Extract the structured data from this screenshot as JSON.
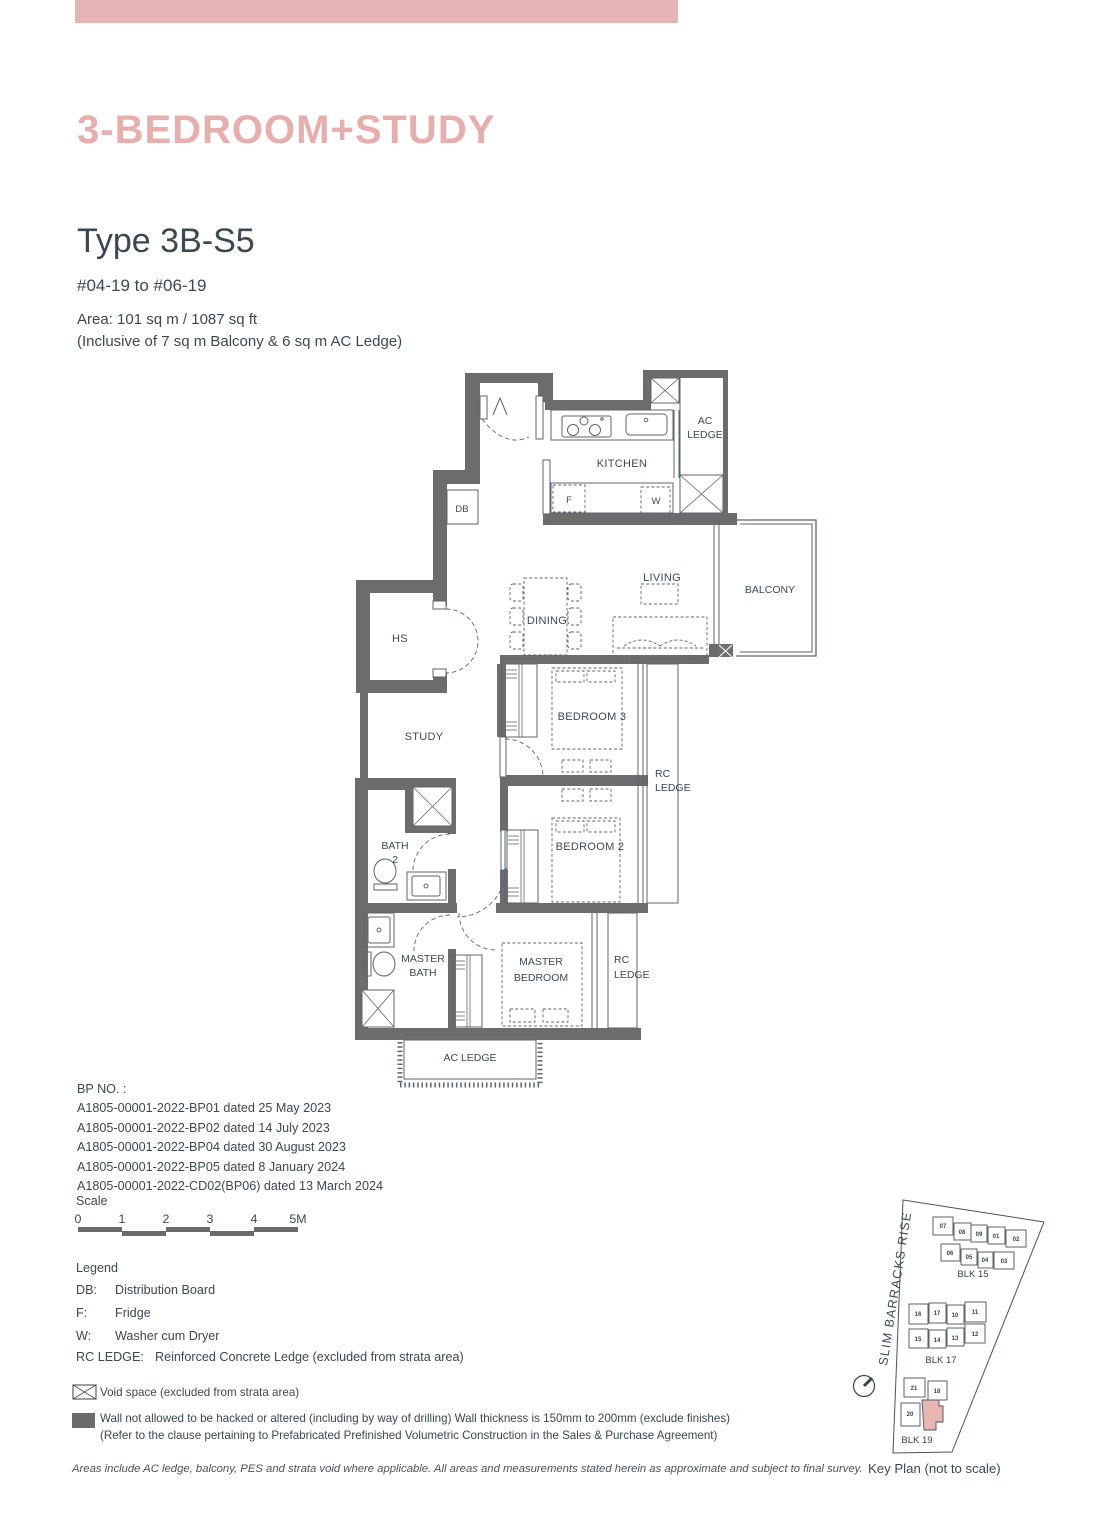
{
  "header": {
    "title": "3-BEDROOM+STUDY"
  },
  "unit": {
    "type": "Type 3B-S5",
    "range": "#04-19 to #06-19",
    "area": "Area: 101 sq m / 1087 sq ft",
    "area_note": "(Inclusive of 7 sq m Balcony & 6 sq m AC Ledge)"
  },
  "plan": {
    "kitchen": "KITCHEN",
    "ac": "AC",
    "ledge": "LEDGE",
    "ac_ledge": "AC LEDGE",
    "living": "LIVING",
    "balcony": "BALCONY",
    "dining": "DINING",
    "hs": "HS",
    "db": "DB",
    "fridge": "F",
    "washer": "W",
    "study": "STUDY",
    "bedroom3": "BEDROOM 3",
    "bedroom2": "BEDROOM 2",
    "rc": "RC",
    "bath": "BATH",
    "bath_no": "2",
    "master": "MASTER",
    "bedroom": "BEDROOM"
  },
  "bp": {
    "heading": "BP NO. :",
    "lines": [
      "A1805-00001-2022-BP01 dated 25 May 2023",
      "A1805-00001-2022-BP02 dated 14 July 2023",
      "A1805-00001-2022-BP04 dated 30 August 2023",
      "A1805-00001-2022-BP05 dated 8 January 2024",
      "A1805-00001-2022-CD02(BP06) dated 13 March 2024"
    ]
  },
  "scale": {
    "heading": "Scale",
    "ticks": [
      "0",
      "1",
      "2",
      "3",
      "4",
      "5M"
    ]
  },
  "legend": {
    "heading": "Legend",
    "items": [
      {
        "key": "DB:",
        "value": "Distribution Board"
      },
      {
        "key": "F:",
        "value": "Fridge"
      },
      {
        "key": "W:",
        "value": "Washer cum Dryer"
      },
      {
        "key": "RC LEDGE:",
        "value": "Reinforced Concrete Ledge (excluded from strata area)"
      }
    ],
    "void_note": "Void space (excluded from strata area)",
    "wall_note_1": "Wall not allowed to be hacked or altered (including by way of drilling) Wall thickness is 150mm to 200mm (exclude finishes)",
    "wall_note_2": "(Refer to the clause pertaining to Prefabricated Prefinished Volumetric Construction in the Sales & Purchase Agreement)"
  },
  "footer": {
    "disclaimer": "Areas include AC ledge, balcony, PES and strata void where applicable. All areas and measurements stated herein as approximate and subject to final survey."
  },
  "keyplan": {
    "road": "SLIM BARRACKS RISE",
    "caption": "Key Plan (not to scale)",
    "blk15": {
      "label": "BLK 15",
      "row1": [
        "07",
        "08",
        "09",
        "01",
        "02"
      ],
      "row2": [
        "06",
        "05",
        "04",
        "03"
      ]
    },
    "blk17": {
      "label": "BLK 17",
      "row1": [
        "16",
        "17",
        "10",
        "11"
      ],
      "row2": [
        "15",
        "14",
        "13",
        "12"
      ]
    },
    "blk19": {
      "label": "BLK 19",
      "row1": [
        "21",
        "18"
      ],
      "row2": [
        "20"
      ]
    }
  },
  "colors": {
    "accent_pink": "#e6b4b4",
    "title_pink": "#e7aeae",
    "keyplan_highlight": "#e9b5b0",
    "wall_gray": "#6b6b6b",
    "text_dark": "#3d474f"
  }
}
